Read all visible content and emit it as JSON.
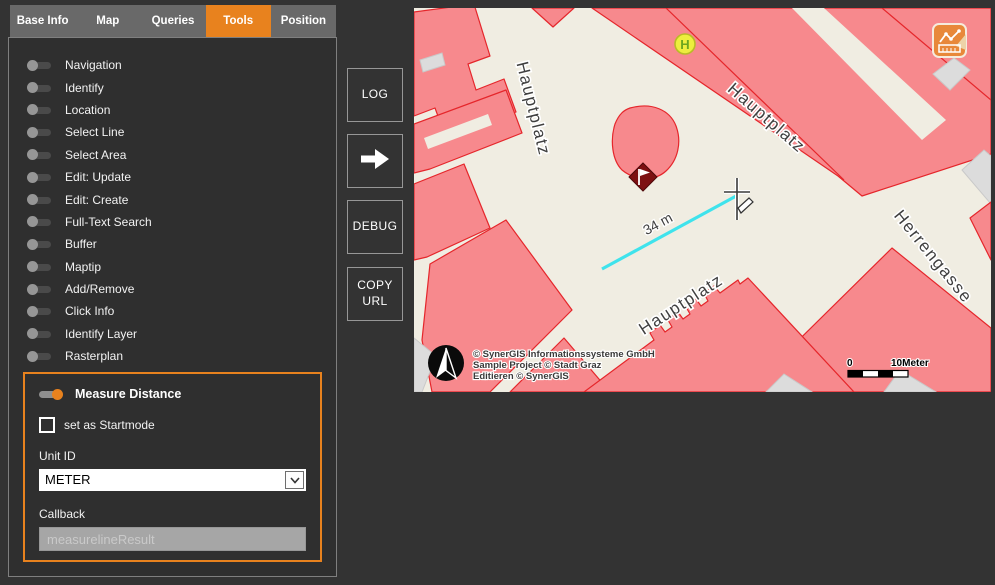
{
  "header": {
    "tabs": [
      {
        "label": "Base Info",
        "active": false
      },
      {
        "label": "Map",
        "active": false
      },
      {
        "label": "Queries",
        "active": false
      },
      {
        "label": "Tools",
        "active": true
      },
      {
        "label": "Position",
        "active": false
      }
    ]
  },
  "tools": {
    "items": [
      "Navigation",
      "Identify",
      "Location",
      "Select Line",
      "Select Area",
      "Edit: Update",
      "Edit: Create",
      "Full-Text Search",
      "Buffer",
      "Maptip",
      "Add/Remove",
      "Click Info",
      "Identify Layer",
      "Rasterplan"
    ]
  },
  "measure_panel": {
    "title": "Measure Distance",
    "toggle_state": "on",
    "startmode_label": "set as Startmode",
    "startmode_checked": false,
    "unit_label": "Unit ID",
    "unit_value": "METER",
    "callback_label": "Callback",
    "callback_value": "measurelineResult"
  },
  "actions": {
    "log": "LOG",
    "debug": "DEBUG",
    "copy_url": "COPY URL"
  },
  "map": {
    "street_labels": [
      {
        "text": "Hauptplatz"
      },
      {
        "text": "Hauptplatz"
      },
      {
        "text": "Herrengasse"
      },
      {
        "text": "Hauptplatz"
      }
    ],
    "stop_marker_label": "H",
    "measurement": {
      "distance": "34 m"
    },
    "attribution": {
      "lines": [
        "© SynerGIS Informationssysteme GmbH",
        "Sample Project © Stadt Graz",
        "Editieren © SynerGIS"
      ]
    },
    "scale_bar": {
      "min": "0",
      "max": "10Meter"
    },
    "colors": {
      "background": "#F0EDE2",
      "building_fill": "#F7898D",
      "building_stroke": "#E5262B",
      "measure_line": "#3FE3EC",
      "accent": "#E8821E",
      "stop_marker_fill": "#EDEE3E",
      "flag_marker_fill": "#7D1012"
    }
  }
}
